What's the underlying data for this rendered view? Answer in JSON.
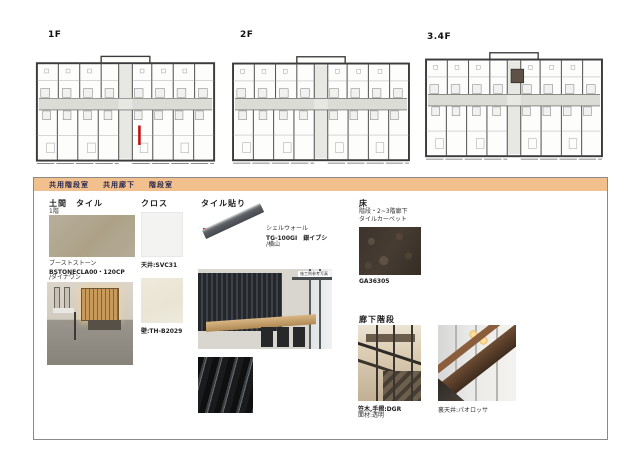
{
  "plans": [
    {
      "label": "1F"
    },
    {
      "label": "2F"
    },
    {
      "label": "3.4F"
    }
  ],
  "legend_tabs": {
    "items": [
      "共用階段室",
      "共用廊下",
      "階段室"
    ]
  },
  "sections": {
    "doma": {
      "title": "土間　タイル",
      "floor": "1階",
      "lines": [
        "ブーストストーン",
        "BSTONECLA00・120CP",
        "/ダイナワン"
      ]
    },
    "cloth": {
      "title": "クロス",
      "ceiling": "天井:SVC31",
      "wall": "壁:TH-B2029"
    },
    "tile": {
      "title": "タイル貼り",
      "lines": [
        "シェルウォール",
        "TG-100GI　銀イブシ",
        "/横山"
      ],
      "photo_label": "施工例参考写真"
    },
    "floor": {
      "title": "床",
      "subtitle1": "階段・2~3階廊下",
      "subtitle2": "タイルカーペット",
      "code": "GA36305"
    },
    "stairs": {
      "title": "廊下階段",
      "caption_left1": "笠木,手摺:DGR",
      "caption_left2": "面材:透明",
      "caption_right": "裏天井:パオロッサ"
    }
  },
  "colors": {
    "tab_bar": "#f2c08c",
    "highlight_red": "#c40b0b",
    "tile_beige": "#b3a894",
    "carpet_brown": "#3e352c"
  }
}
